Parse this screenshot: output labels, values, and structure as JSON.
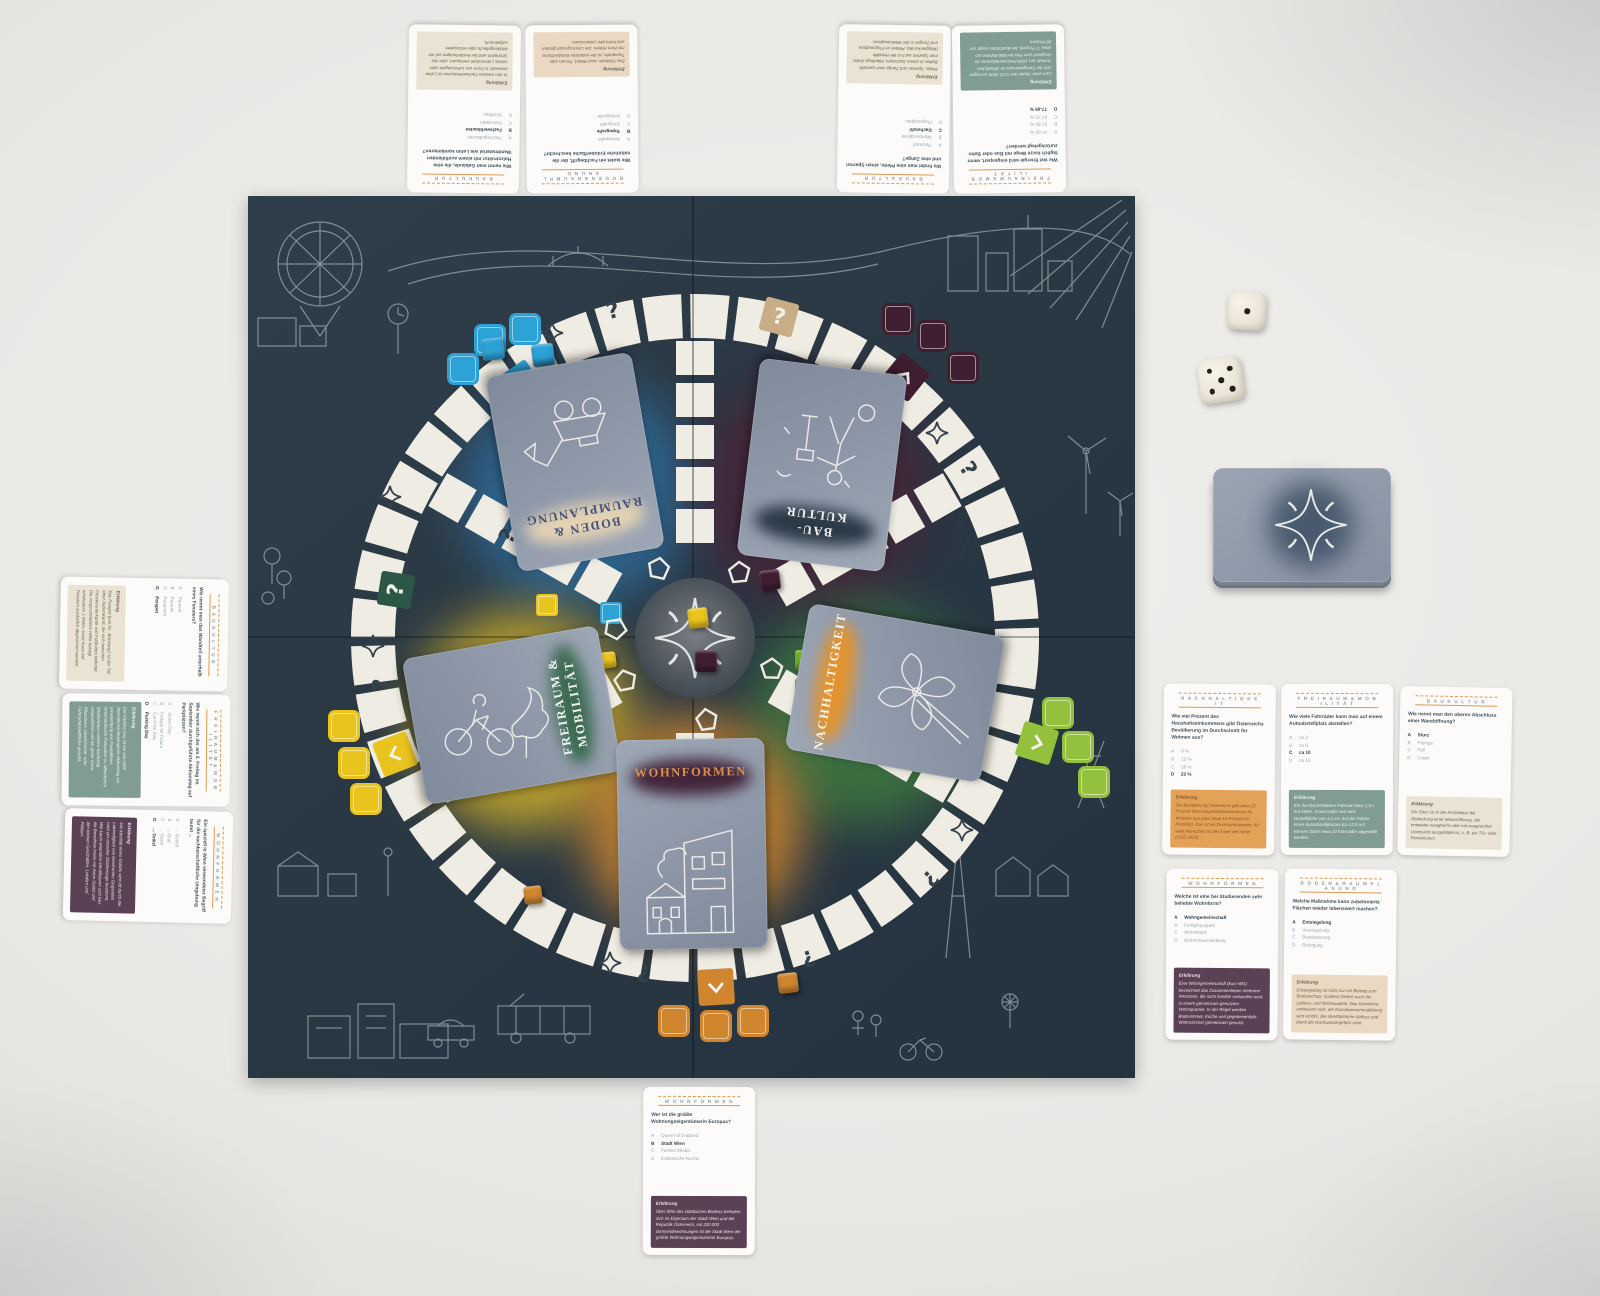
{
  "palette": {
    "board": "#2a3844",
    "blue": "#2da2d6",
    "maroon": "#401e31",
    "yellow": "#e9c41f",
    "green_cube": "#76b32a",
    "green_square": "#93c13d",
    "orange": "#d0862f",
    "tan": "#c7ae87",
    "dark_green": "#2c5746",
    "card_back": "#8d97a7"
  },
  "board": {
    "track_symbols": {
      "question": "?",
      "question_inverted": "¿",
      "star": "four-point-star",
      "chevron": "chevron"
    },
    "categories": [
      {
        "key": "boden",
        "label": "BODEN & RAUMPLANUNG",
        "color": "#2da2d6"
      },
      {
        "key": "baukultur",
        "label": "BAUKULTUR",
        "color": "#401e31"
      },
      {
        "key": "freiraum",
        "label": "FREIRAUM & MOBILITÄT",
        "color": "#e9c41f"
      },
      {
        "key": "nachhaltigkeit",
        "label": "NACHHALTIGKEIT",
        "color": "#93c13d"
      },
      {
        "key": "wohnformen",
        "label": "WOHNFORMEN",
        "color": "#d0862f"
      }
    ]
  },
  "category_styles": {
    "baukultur": {
      "bg": "#eae2d2",
      "fg": "#6b6152"
    },
    "boden": {
      "bg": "#e9d9c2",
      "fg": "#6b6152"
    },
    "freiraum": {
      "bg": "#809c93",
      "fg": "#f1f3ef"
    },
    "nachhaltigkeit": {
      "bg": "#e4a259",
      "fg": "#8a5524"
    },
    "wohnformen": {
      "bg": "#5a4156",
      "fg": "#ece4ea"
    }
  },
  "decks": [
    {
      "label": "BODEN & RAUMPLANUNG",
      "smudge_color": "#e3d2b4",
      "label_color": "#455277"
    },
    {
      "label": "BAU-KULTUR",
      "smudge_color": "#2b3947",
      "label_color": "#f2f3f0"
    },
    {
      "label": "FREIRAUM & MOBILITÄT",
      "smudge_color": "#3c6b52",
      "label_color": "#eef2ee"
    },
    {
      "label": "NACHHALTIGKEIT",
      "smudge_color": "#e2932f",
      "label_color": "#f6f3ec"
    },
    {
      "label": "WOHNFORMEN",
      "smudge_color": "#42243a",
      "label_color": "#d8914b"
    }
  ],
  "draw_pile": {
    "icon": "four-point-star-icon"
  },
  "dice": {
    "values": [
      1,
      5
    ]
  },
  "explanation_title": "Erklärung",
  "cards": [
    {
      "category_key": "baukultur",
      "category": "B A U K U L T U R",
      "question": "Wie nennt man Gebäude, die eine Holzstruktur mit einem ausfüllenden Wandmaterial wie Lehm kombinieren?",
      "options": [
        {
          "letter": "A",
          "text": "Holzriegelbauten"
        },
        {
          "letter": "B",
          "text": "Fachwerkbauten"
        },
        {
          "letter": "C",
          "text": "Holzstadel"
        },
        {
          "letter": "D",
          "text": "Strohbau"
        }
      ],
      "answer": "B",
      "explanation": "In den meisten Fachwerkhäusern ist Lehm entweder in Form von Lehmziegeln oder mittels Lehmmörtel vermauert, oder der Strohlehm wird bei Ausfachungen auf ein Weidengeflecht oder Holzstaken aufgebracht."
    },
    {
      "category_key": "boden",
      "category": "B O D E N  &  R A U M P L A N U N G",
      "question": "Wie lautet ein Fachbegriff, der die natürliche Erdoberfläche beschreibt?",
      "options": [
        {
          "letter": "A",
          "text": "Sonografie"
        },
        {
          "letter": "B",
          "text": "Topografie"
        },
        {
          "letter": "C",
          "text": "Geografie"
        },
        {
          "letter": "D",
          "text": "Kartografie"
        }
      ],
      "answer": "B",
      "explanation": "Das Gelände, auch Relief, Terrain oder Topografie, ist die natürliche Erdoberfläche mit ihren Höhen. Die Umrissgestalt gliedert und formt den Lebensraum."
    },
    {
      "category_key": "baukultur",
      "category": "B A U K U L T U R",
      "question": "Wo findet man eine Pfette, einen Sparren und eine Zange?",
      "options": [
        {
          "letter": "A",
          "text": "Heustadl"
        },
        {
          "letter": "B",
          "text": "Werkzeugkiste"
        },
        {
          "letter": "C",
          "text": "Dachstuhl"
        },
        {
          "letter": "D",
          "text": "Flugzeugbau"
        }
      ],
      "answer": "C",
      "explanation": "Pfette, Sparren und Zange sind spezielle Balken in einem Dachstuhl. Allerdings findet man Sparren auch in der Heraldik (Wappenkunde), Pfetten im Flugzeugbau und Zangen in der Werkzeugkiste."
    },
    {
      "category_key": "freiraum",
      "category": "F R E I R A U M  &  M O B I L I T Ä T",
      "question": "Wie viel Energie wird eingespart, wenn täglich kurze Wege mit Bus oder Bahn zurückgelegt werden?",
      "options": [
        {
          "letter": "A",
          "text": "47-55 %"
        },
        {
          "letter": "B",
          "text": "57-65 %"
        },
        {
          "letter": "C",
          "text": "67-75 %"
        },
        {
          "letter": "D",
          "text": "77-85 %"
        }
      ],
      "answer": "D",
      "explanation": "Laut einer Studie des VCÖ 2009 verringert sich der Energieeinsatz im öffentlichen Verkehr pro 1000 Personenkilometer im Vergleich zum Pkw bei Bahnfahrten um etwa 77 Prozent, bei Busfahrten sogar um 85 Prozent."
    },
    {
      "category_key": "baukultur",
      "category": "B A U K U L T U R",
      "question": "Wie nennt man das Wandteil unterhalb eines Fensters?",
      "options": [
        {
          "letter": "A",
          "text": "Parasol"
        },
        {
          "letter": "B",
          "text": "Parodie"
        },
        {
          "letter": "C",
          "text": "Parament"
        },
        {
          "letter": "D",
          "text": "Parapet"
        }
      ],
      "answer": "D",
      "explanation": "Das Parapet (von frz. ‚Brüstung') ist der Teil einer Außenwand, der sich zwischen Fensterunterkante und Fußboden befindet. Die vorgeschriebene Höhe beträgt mindestens 1 Meter, sonst muss bei Fenstern zusätzlich abgesichert werden."
    },
    {
      "category_key": "freiraum",
      "category": "F R E I R A U M  &  M O B I L I T Ä T",
      "question": "Wie nennt sich der am 3. Freitag im September durchgeführte Aktionstag auf Parkplätzen?",
      "options": [
        {
          "letter": "A",
          "text": "Action Day"
        },
        {
          "letter": "B",
          "text": "Fridays for Future"
        },
        {
          "letter": "C",
          "text": "Car-Free Day"
        },
        {
          "letter": "D",
          "text": "Parking Day"
        }
      ],
      "answer": "D",
      "explanation": "Der Parking Day ist ein seit 2005 international begangener Aktionstag zur Umwandlung von Parkplätzen. Innerstädtische Parkplätze im öffentlichen Straßenraum werden kurzfristig umgewidmet und als grüne Oase, Pflanzbeet, Gastronomie- oder Fahrradabstellfläche genutzt."
    },
    {
      "category_key": "wohnformen",
      "category": "W O H N F O R M E N",
      "question": "Ein speziell in Wien verwendeter Begriff für die nachbarschaftliche Umgebung lautet ...",
      "options": [
        {
          "letter": "A",
          "text": "... Gstettl"
        },
        {
          "letter": "B",
          "text": "... Graf"
        },
        {
          "letter": "C",
          "text": "... Gassl"
        },
        {
          "letter": "D",
          "text": "... Grätzl"
        }
      ],
      "answer": "D",
      "explanation": "Die Identität eines Grätzls wird oft durch die Lebendigkeit von bestimmten Gegenden rund um einzelne Straßenzüge bestimmt. Wie kaum woanders identifizieren sich hier die Bewohner:innen mit ihrem Grätzl und den kleinen Geschäften, Lokalen und Plätzen."
    },
    {
      "category_key": "nachhaltigkeit",
      "category": "N A C H H A L T I G K E I T",
      "question": "Wie viel Prozent des Haushaltseinkommens gibt Österreichs Bevölkerung im Durchschnitt für Wohnen aus?",
      "options": [
        {
          "letter": "A",
          "text": "8 %"
        },
        {
          "letter": "B",
          "text": "13 %"
        },
        {
          "letter": "C",
          "text": "18 %"
        },
        {
          "letter": "D",
          "text": "23 %"
        }
      ],
      "answer": "D",
      "explanation": "Die Bevölkerung Österreichs gibt etwa 23 Prozent ihres Haushaltseinkommens für Wohnen aus (plus etwa 14 Prozent für Mobilität). Das ist ein Durchschnittswert, für viele Menschen ist der Anteil viel höher. (VCÖ 2020)"
    },
    {
      "category_key": "freiraum",
      "category": "F R E I R A U M  &  M O B I L I T Ä T",
      "question": "Wie viele Fahrräder kann man auf einem Autoabstellplatz abstellen?",
      "options": [
        {
          "letter": "A",
          "text": "ca 3"
        },
        {
          "letter": "B",
          "text": "ca 6"
        },
        {
          "letter": "C",
          "text": "ca 10"
        },
        {
          "letter": "D",
          "text": "ca 15"
        }
      ],
      "answer": "C",
      "explanation": "Ein durchschnittliches Fahrrad misst 1,8 x 0,6 Meter. Somit ergibt sich eine Grundfläche von 1,2 m². Auf der Fläche eines Autoabstellplatzes (ca 12,5 m²) können daher etwa 10 Fahrräder abgestellt werden."
    },
    {
      "category_key": "baukultur",
      "category": "B A U K U L T U R",
      "question": "Wie nennt man den oberen Abschluss einer Wandöffnung?",
      "options": [
        {
          "letter": "A",
          "text": "Sturz"
        },
        {
          "letter": "B",
          "text": "Plumps"
        },
        {
          "letter": "C",
          "text": "Fall"
        },
        {
          "letter": "D",
          "text": "Crash"
        }
      ],
      "answer": "A",
      "explanation": "Ein Sturz ist in der Architektur die Abdeckung einer Maueröffnung, die entweder waagrecht oder mit waagrechter Untersicht ausgebildet ist, z. B. ein Tür- oder Fenstersturz."
    },
    {
      "category_key": "wohnformen",
      "category": "W O H N F O R M E N",
      "question": "Welche ist eine bei Studierenden sehr beliebte Wohnform?",
      "options": [
        {
          "letter": "A",
          "text": "Wohngemeinschaft"
        },
        {
          "letter": "B",
          "text": "Fertighauspark"
        },
        {
          "letter": "C",
          "text": "Wohnblock"
        },
        {
          "letter": "D",
          "text": "Reihenhaussiedlung"
        }
      ],
      "answer": "A",
      "explanation": "Eine Wohngemeinschaft (kurz WG) bezeichnet das Zusammenleben mehrerer Personen, die nicht familiär verbunden sind, in einem gemeinsam genutzten Wohnquartier. In der Regel werden Badezimmer, Küche und gegebenenfalls Wohnzimmer gemeinsam genutzt."
    },
    {
      "category_key": "boden",
      "category": "B O D E N  &  R A U M P L A N U N G",
      "question": "Welche Maßnahme kann zubetonierte Flächen wieder lebenswert machen?",
      "options": [
        {
          "letter": "A",
          "text": "Entsiegelung"
        },
        {
          "letter": "B",
          "text": "Versiegelung"
        },
        {
          "letter": "C",
          "text": "Bewässerung"
        },
        {
          "letter": "D",
          "text": "Reinigung"
        }
      ],
      "answer": "A",
      "explanation": "Entsiegelung ist nicht nur ein Beitrag zum Bodenschutz, sondern fördert auch die Lebens- und Wohnqualität. Das Kleinklima verbessert sich, die Grundwasserneubildung wird erhöht, der oberflächliche Abfluss und damit die Hochwassergefahr sinkt."
    },
    {
      "category_key": "wohnformen",
      "category": "W O H N F O R M E N",
      "question": "Wer ist die größte Wohnungseigentümerin Europas?",
      "options": [
        {
          "letter": "A",
          "text": "Queen of England"
        },
        {
          "letter": "B",
          "text": "Stadt Wien"
        },
        {
          "letter": "C",
          "text": "Familie Medici"
        },
        {
          "letter": "D",
          "text": "Katholische Kirche"
        }
      ],
      "answer": "B",
      "explanation": "Über 50% des städtischen Bodens befinden sich im Eigentum der Stadt Wien und der Republik Österreich, mit 220.000 Gemeindewohnungen ist die Stadt Wien die größte Wohnungseigentümerin Europas."
    }
  ]
}
